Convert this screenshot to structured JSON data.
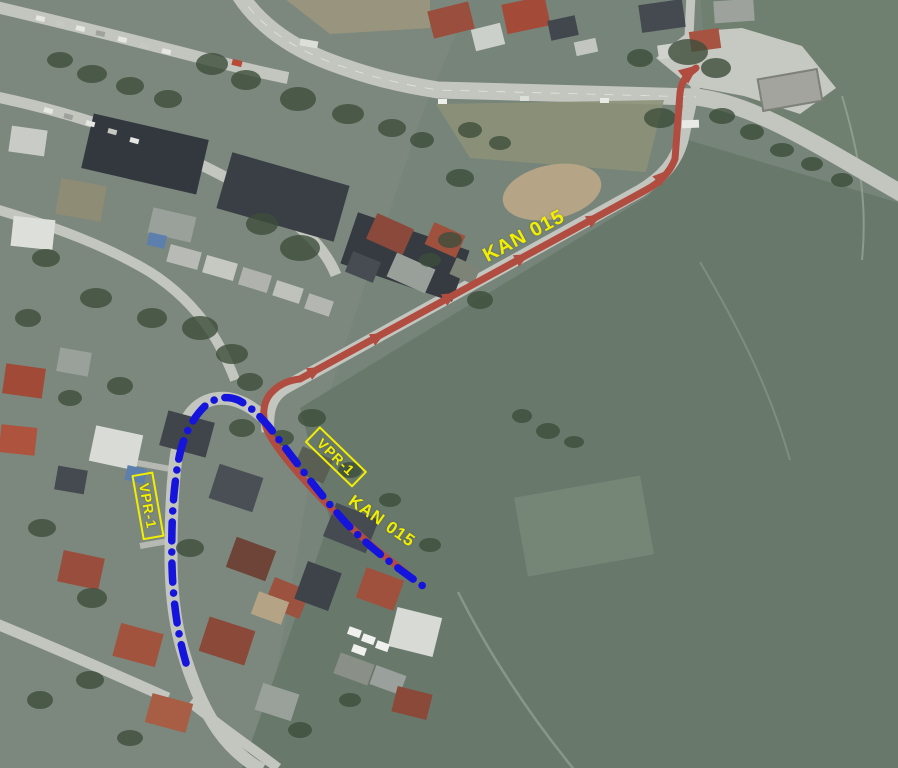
{
  "colors": {
    "kan_red": "#b14c40",
    "vpr_blue": "#1414dc",
    "label_yellow": "#f2ee00"
  },
  "annotations": {
    "kan_line": {
      "name": "KAN 015",
      "d": "M 405,572 C 378,552 349,527 321,498 C 299,475 279,452 269,434 C 261,419 262,401 273,391 C 280,384 290,380 300,379 L 646,190 C 661,182 670,172 675,159 L 680,93 C 681,84 685,77 691,72 L 696,68",
      "width": "7",
      "arrow_points": "0,-6.5 15,0 0,6.5",
      "arrows": [
        {
          "transform": "translate(309,374) rotate(-28.6)"
        },
        {
          "transform": "translate(372,340) rotate(-28.6)"
        },
        {
          "transform": "translate(444,300) rotate(-28.6)"
        },
        {
          "transform": "translate(516,261) rotate(-28.6)"
        },
        {
          "transform": "translate(588,222) rotate(-28.6)"
        },
        {
          "transform": "translate(657,181) rotate(-45)"
        },
        {
          "transform": "translate(683,77) rotate(-38) scale(1.3)"
        }
      ]
    },
    "vpr_line": {
      "name": "VPR-1",
      "d": "M 186,663 C 178,636 173,602 172,566 C 171,527 173,492 178,463 C 182,440 190,421 204,407 C 213,398 226,395 238,400 C 250,406 260,416 270,428 C 294,459 320,495 347,524 C 372,550 399,569 427,589",
      "width": "7.5",
      "dash": "19 11 0.1 11"
    },
    "labels": [
      {
        "text": "KAN 015",
        "style": "left:524px;top:236px;font-size:20px;transform:translate(-50%,-50%) rotate(-28deg);"
      },
      {
        "text": "VPR-1",
        "style": "left:336px;top:457px;font-size:14px;transform:translate(-50%,-50%) rotate(44deg);"
      },
      {
        "text": "KAN 015",
        "style": "left:382px;top:521px;font-size:17px;transform:translate(-50%,-50%) rotate(35deg);"
      },
      {
        "text": "VPR-1",
        "style": "left:148px;top:506px;font-size:14px;transform:translate(-50%,-50%) rotate(80deg);"
      }
    ]
  }
}
